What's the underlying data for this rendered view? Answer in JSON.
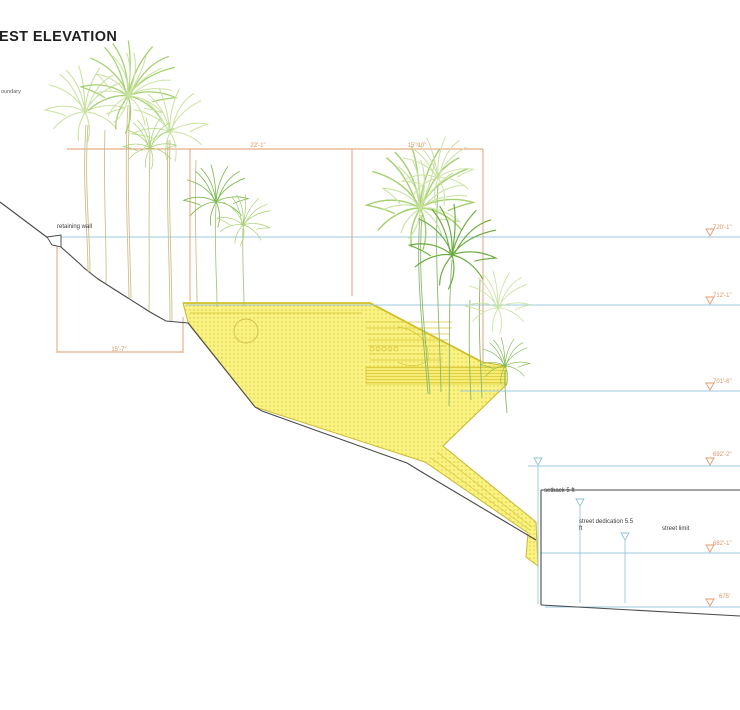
{
  "title": "EST ELEVATION",
  "annotations": {
    "boundary": "oundary",
    "retaining_wall": "retaining wall",
    "setback": "setback 5 ft",
    "street_dedication": "street dedication 5.5 ft",
    "street_limit": "street limit"
  },
  "dimensions": {
    "upper_left": "22'-1\"",
    "upper_right": "15'-10\"",
    "lower_left": "15'-7\""
  },
  "elevation_markers": [
    {
      "label": "720'-1\""
    },
    {
      "label": "712'-1\""
    },
    {
      "label": "701'-6\""
    },
    {
      "label": "692'-2\""
    },
    {
      "label": "682'-1\""
    },
    {
      "label": "675'"
    }
  ],
  "colors": {
    "dimension_orange": "#dd9464",
    "level_blue": "#9cc8dc",
    "building_yellow": "#f8f180",
    "building_edge": "#cbb72c",
    "ground_black": "#4a4a4a",
    "palm_green_light": "#c9e2a0",
    "palm_green_mid": "#a5d06e",
    "palm_green_dark": "#7db84e"
  }
}
